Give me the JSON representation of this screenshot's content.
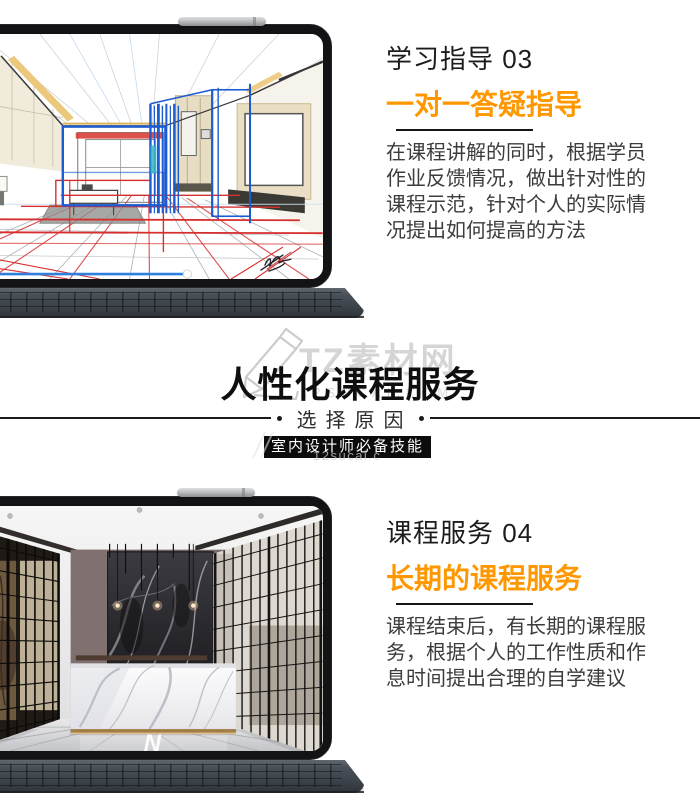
{
  "colors": {
    "accent_orange": "#ff9800",
    "title_text": "#1c1c1c",
    "body_text": "#3c3c3c",
    "badge_bg": "#0c0c0c",
    "badge_text": "#ffffff",
    "watermark_gray": "#d5d5d5",
    "sketch_line_red": "#d62f2f",
    "sketch_line_blue": "#1d5bd0"
  },
  "study": {
    "heading": "学习指导 03",
    "subheading": "一对一答疑指导",
    "body": "在课程讲解的同时，根据学员作业反馈情况，做出针对性的课程示范，针对个人的实际情况提出如何提高的方法",
    "screen_alt": "interior-perspective-sketch"
  },
  "middle": {
    "watermark_logo": "TZ素材网",
    "watermark_url": "12SUCAI.COM",
    "watermark_url_small": "12sucai.c",
    "title": "人性化课程服务",
    "divider_label": "选择原因",
    "badge": "室内设计师必备技能"
  },
  "service": {
    "heading": "课程服务 04",
    "subheading": "长期的课程服务",
    "body": "课程结束后，有长期的课程服务，根据个人的工作性质和作息时间提出合理的自学建议",
    "screen_alt": "reception-hall-render",
    "floor_logo": "N"
  }
}
